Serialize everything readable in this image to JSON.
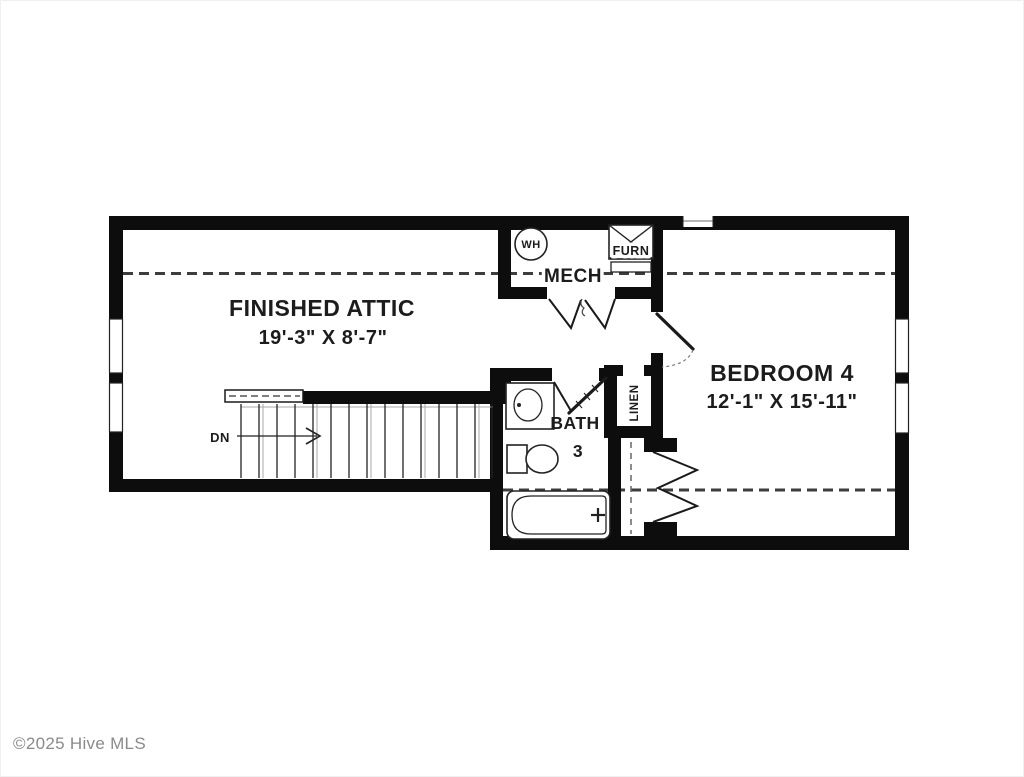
{
  "colors": {
    "background": "#ffffff",
    "wall": "#0d0d0d",
    "line": "#222222",
    "dash": "#3d3d3d",
    "light_gray": "#aaaaaa",
    "watermark": "#8a8a8a"
  },
  "watermark": {
    "text": "©2025 Hive MLS"
  },
  "rooms": {
    "finished_attic": {
      "name": "FINISHED ATTIC",
      "dims": "19'-3\" X 8'-7\""
    },
    "bedroom_4": {
      "name": "BEDROOM 4",
      "dims": "12'-1\" X 15'-11\""
    },
    "bath_3": {
      "name": "BATH",
      "number": "3"
    },
    "mech": {
      "name": "MECH"
    },
    "linen": {
      "name": "LINEN"
    }
  },
  "symbols": {
    "water_heater": "WH",
    "furnace": "FURN",
    "stairs_direction": "DN"
  }
}
